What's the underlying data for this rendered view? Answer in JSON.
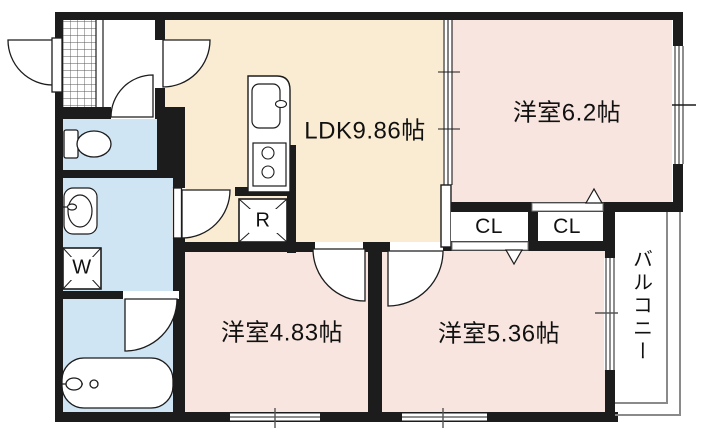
{
  "floorplan": {
    "rooms": {
      "ldk": {
        "label": "LDK9.86帖"
      },
      "bedroom_top_right": {
        "label": "洋室6.2帖"
      },
      "bedroom_bottom_left": {
        "label": "洋室4.83帖"
      },
      "bedroom_bottom_right": {
        "label": "洋室5.36帖"
      },
      "closet_left": {
        "label": "CL"
      },
      "closet_right": {
        "label": "CL"
      },
      "balcony": {
        "label": "バルコニー"
      }
    },
    "appliances": {
      "washing_machine": {
        "label": "W"
      },
      "refrigerator": {
        "label": "R"
      }
    },
    "colors": {
      "ldk_floor": "#faecd2",
      "bedroom_floor": "#f9e5df",
      "wet_area_floor": "#cfe5f4",
      "wall": "#1c1c1c",
      "balcony_line": "#8a8a8a"
    }
  }
}
